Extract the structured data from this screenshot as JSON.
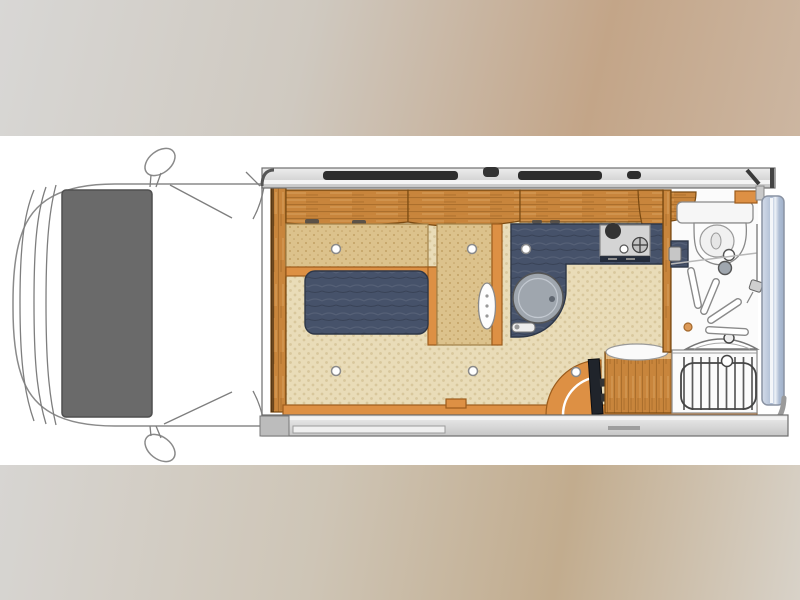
{
  "scene": {
    "type": "floorplan-illustration",
    "subject": "campervan-motorhome-top-view",
    "orientation": "cab-on-left",
    "visible_text": "none"
  },
  "colors": {
    "canvas": "#ffffff",
    "bg_top_1": "#d8d7d5",
    "bg_top_2": "#cfc9c0",
    "bg_top_3": "#c3a588",
    "bg_top_4": "#ccb6a1",
    "bg_bot_1": "#d7d5d2",
    "bg_bot_2": "#cec5b6",
    "bg_bot_3": "#c2ac8e",
    "bg_bot_4": "#d8d2c8",
    "wood": "#c8853c",
    "wood_edge": "#7a4a12",
    "trim": "#dd9044",
    "trim_edge": "#9c5c1c",
    "upholstery": "#dcc28c",
    "upholstery_dot": "#c2a165",
    "uph_edge": "#a08048",
    "carpet": "#e9dcb8",
    "carpet_dot": "#d8c79c",
    "navy": "#46526a",
    "navy_edge": "#2e3748",
    "cab_gray": "#6a6a6a",
    "cab_gray_edge": "#4f4f4f",
    "bar_light": "#ededed",
    "bar_mid": "#c6c6c6",
    "bar_edge": "#6e6e6e",
    "window_dark": "#2d2d2d",
    "blue_1": "#d4dce9",
    "blue_2": "#aebdd4",
    "blue_edge": "#8a93a3",
    "outline": "#8a8a8a",
    "fixture": "#f6f6f6",
    "sink": "#9fa6ae"
  },
  "plan": {
    "cab": [
      "van-body-outline",
      "front-contour-lines",
      "overcab-panel",
      "wing-mirror-top",
      "wing-mirror-bottom",
      "windshield-lines"
    ],
    "shell": [
      "top-wall-bar",
      "window-slit-1",
      "roof-vent-tab",
      "window-slit-2",
      "window-slit-3",
      "bottom-wall-bar",
      "sliding-door-track",
      "entry-step-sill",
      "rear-frame",
      "rear-door-panel"
    ],
    "living": [
      "cab-partition-wall",
      "overhead-lockers",
      "bench-seat",
      "seat-ledge",
      "side-cabinet",
      "cabinet-door-handle",
      "lounge-table",
      "carpet-floor",
      "press-stud-dots"
    ],
    "kitchen": [
      "kitchen-counter",
      "kitchen-sink",
      "sink-faucet",
      "hob-stove",
      "stove-burners",
      "stove-knob",
      "drawer-handles"
    ],
    "rear": [
      "entry-door-swing",
      "entry-door-leaf",
      "entry-step",
      "wardrobe",
      "heater-grate-unit",
      "washbasin",
      "basin-faucet"
    ],
    "bathroom": [
      "bathroom-wall",
      "bathroom-locker",
      "toilet-cistern",
      "toilet-bowl",
      "flush-button",
      "shower-mixer",
      "shower-spray-jets",
      "shower-riser-rail",
      "drain-dot"
    ]
  }
}
